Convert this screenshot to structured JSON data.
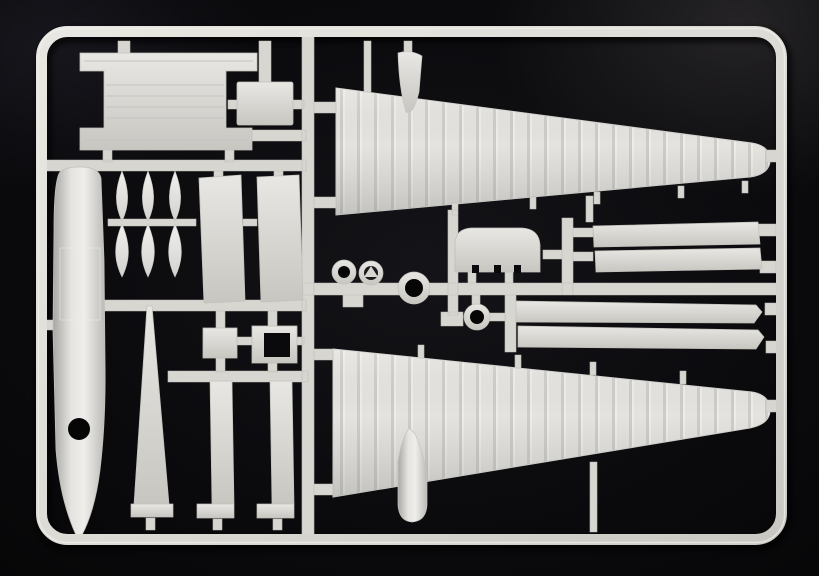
{
  "scene": {
    "type": "photograph",
    "description": "Light grey injection-moulded plastic model kit sprue (parts tree) for an aircraft kit, photographed on a black background",
    "visible_text": ""
  },
  "colors": {
    "background": "#0a0a0d",
    "background_corner_highlight": "#232226",
    "plastic": "#dcdad5",
    "plastic_highlight": "#efeeea",
    "plastic_shadow": "#aba9a4",
    "opening": "#060607"
  },
  "sprue": {
    "frame": "rounded rectangular outer sprue frame",
    "runners": "internal runner bars and gate tabs connecting all parts",
    "parts": {
      "tailplane": "H-shaped tailplane piece, top left",
      "small_panel": "small rectangular panel beside tailplane",
      "fuselage_half": "long fuselage boom half with circular opening, left edge",
      "propeller_blades": "six propeller blades in two rows of three",
      "door_panel_left": "tall flat door panel, upper middle (left)",
      "door_panel_right": "tall flat door panel, upper middle (right)",
      "square_plate": "small square plate",
      "open_box": "small open box piece with dark cavity",
      "tail_fin": "long tapered fin, lower left",
      "gear_door_left": "narrow strip with bottom tab, lower middle (left)",
      "gear_door_right": "narrow strip with bottom tab, lower middle (right)",
      "wing_upper": "large tapered wing half, top right",
      "wing_lower": "large tapered wing half, bottom right",
      "wing_fin_upper": "small fin fairing standing on the upper wing",
      "wing_pod_lower": "small pod fairing hanging below the lower wing",
      "cowl": "rounded cowl piece with notched base, centre",
      "ring_small": "small ring piece left of centre hub",
      "wheel_hub": "small wheel piece with triangular hub",
      "ring_large": "large ring piece on the central runner",
      "ring_right": "small ring piece below centre runner",
      "flap_strip_upper_1": "long flat flap strip, centre right (upper pair, first)",
      "flap_strip_upper_2": "long flat flap strip, centre right (upper pair, second)",
      "flap_strip_lower_1": "long flap strip with angled end (lower pair, first)",
      "flap_strip_lower_2": "long flap strip with angled end (lower pair, second)"
    }
  }
}
